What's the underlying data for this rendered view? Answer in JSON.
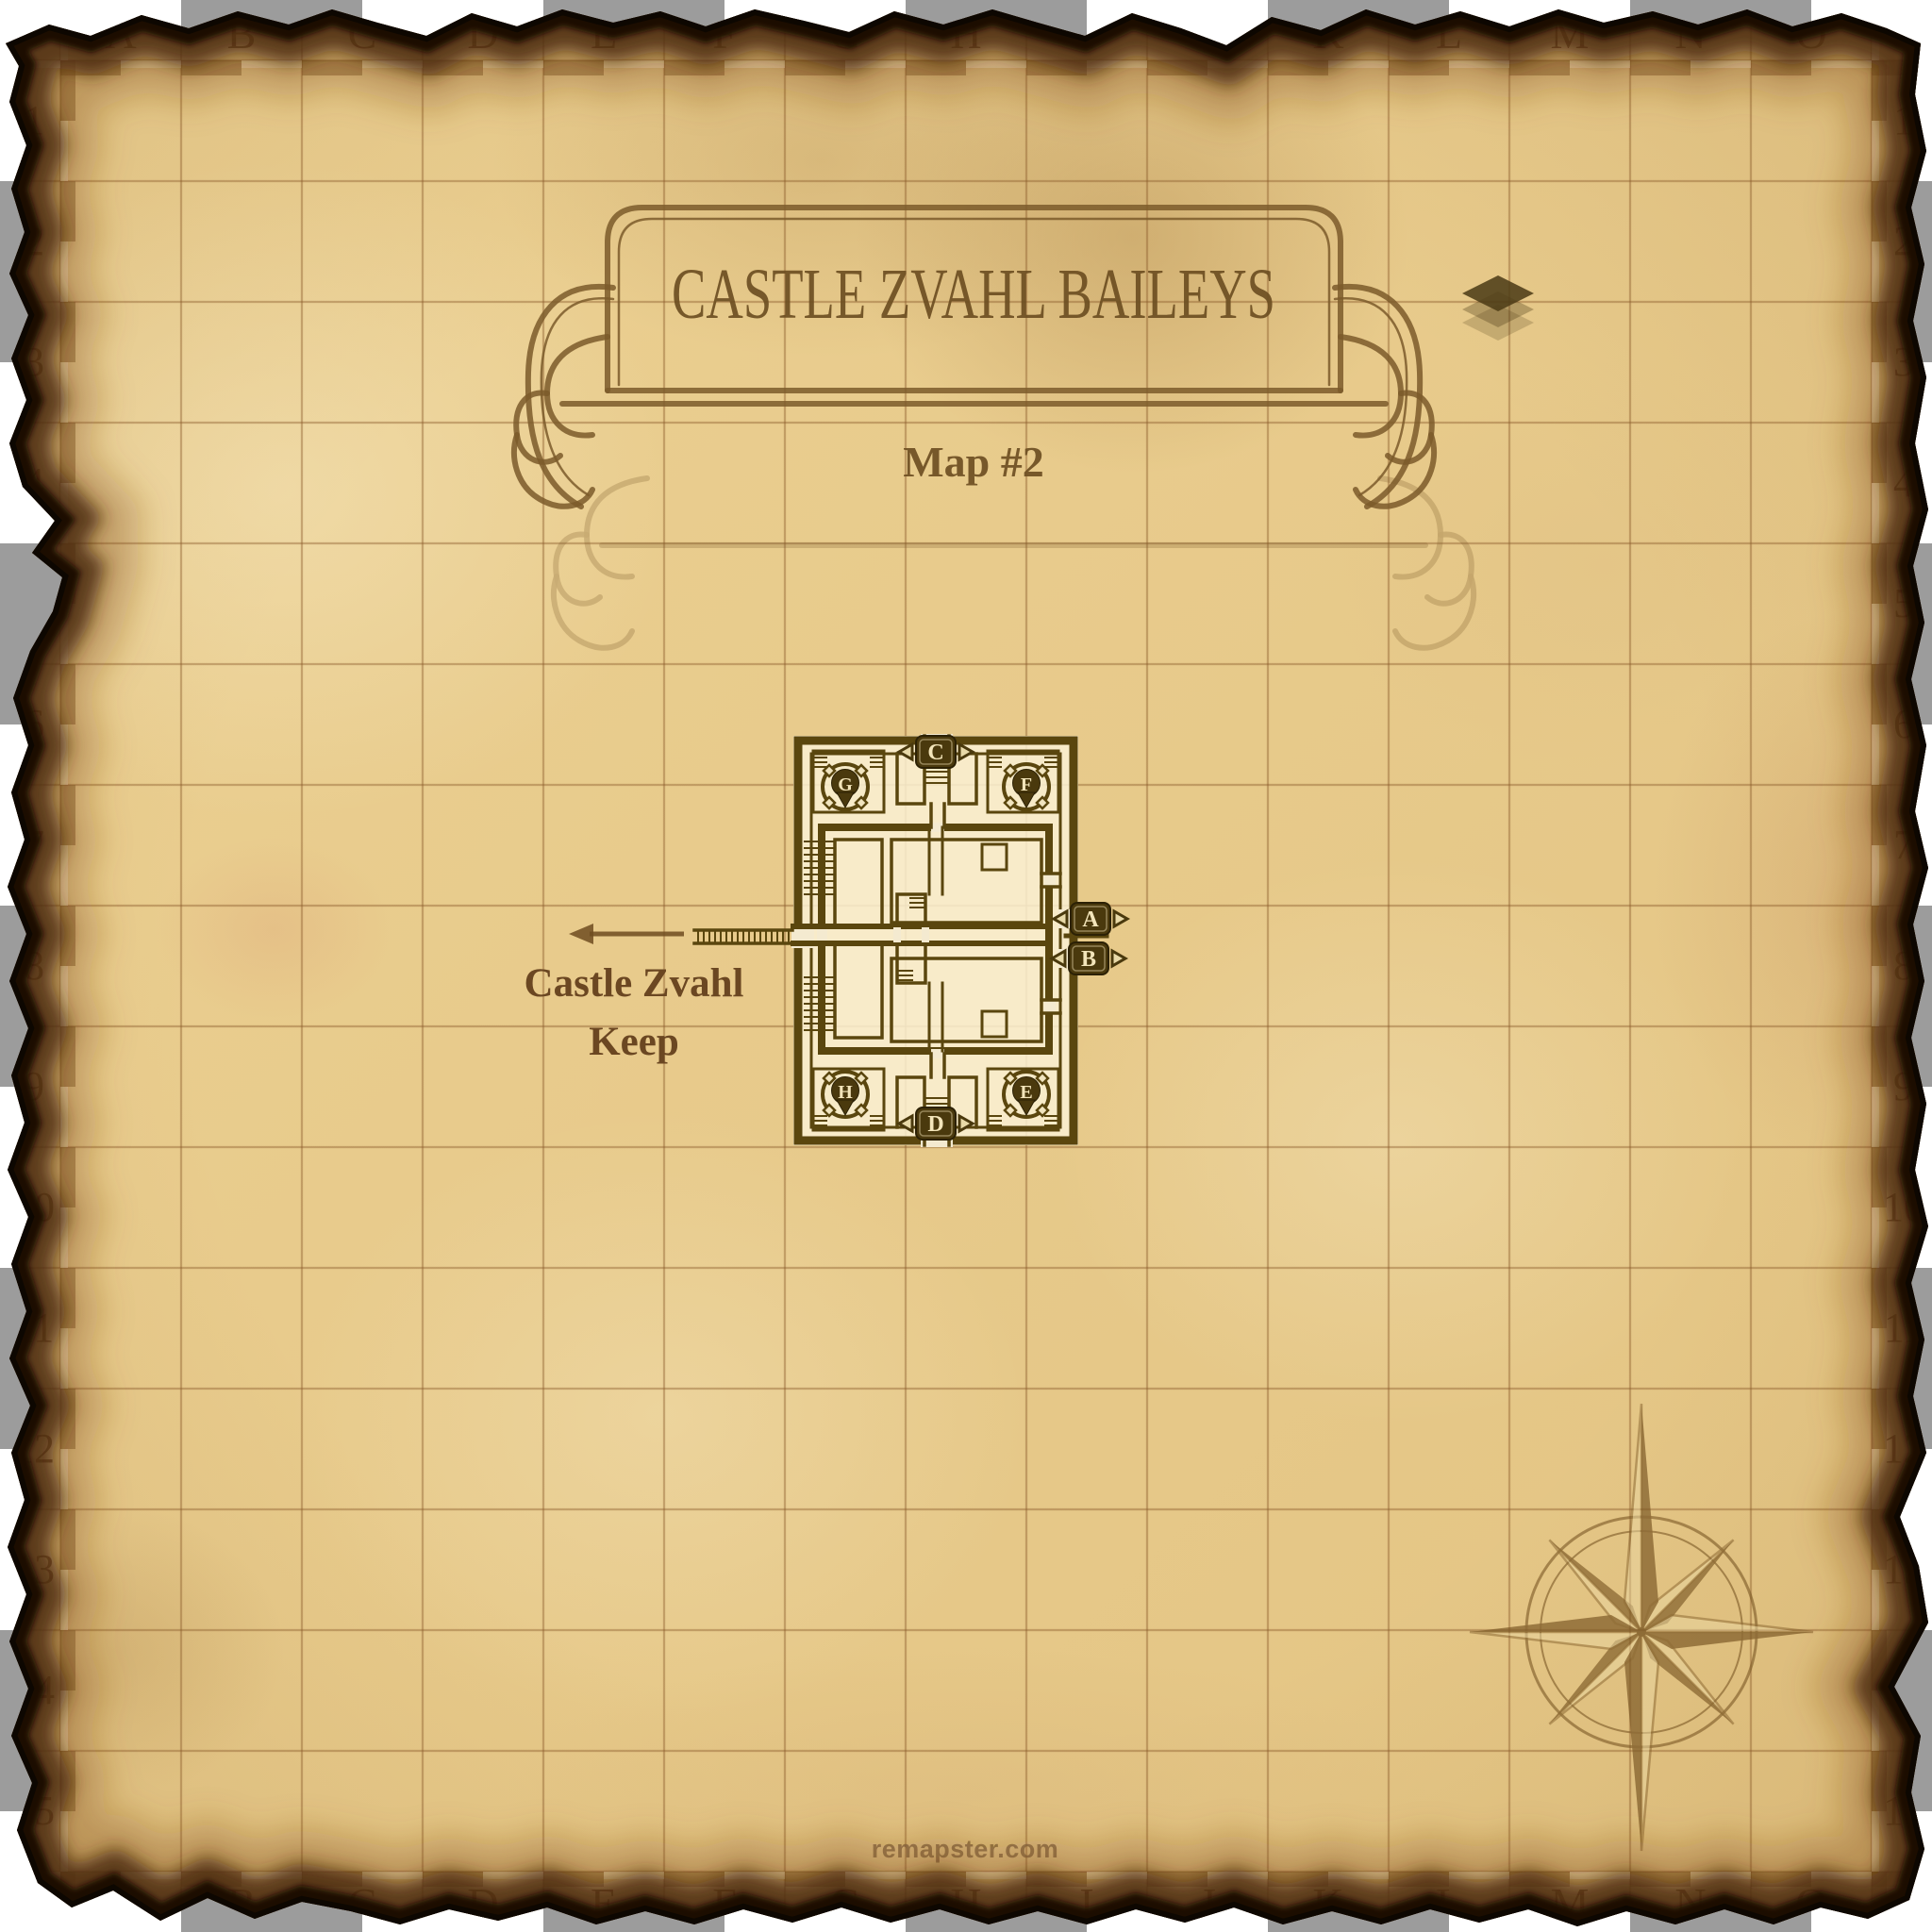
{
  "map": {
    "title": "CASTLE ZVAHL BAILEYS",
    "subtitle": "Map #2",
    "grid": {
      "columns": [
        "A",
        "B",
        "C",
        "D",
        "E",
        "F",
        "G",
        "H",
        "I",
        "J",
        "K",
        "L",
        "M",
        "N",
        "O"
      ],
      "rows": [
        "1",
        "2",
        "3",
        "4",
        "5",
        "6",
        "7",
        "8",
        "9",
        "10",
        "11",
        "12",
        "13",
        "14",
        "15"
      ]
    },
    "annotations": {
      "keep_line1": "Castle Zvahl",
      "keep_line2": "Keep"
    },
    "castle": {
      "exit_markers": [
        {
          "label": "A"
        },
        {
          "label": "B"
        },
        {
          "label": "C"
        },
        {
          "label": "D"
        }
      ],
      "pin_markers": [
        {
          "label": "E"
        },
        {
          "label": "F"
        },
        {
          "label": "G"
        },
        {
          "label": "H"
        }
      ]
    },
    "watermark": "remapster.com",
    "colors": {
      "parchment": "#e8cb8c",
      "ink": "#6e4a1c",
      "wall": "#5a460e",
      "badge_fill": "#4a390d",
      "badge_text": "#f3e5ba",
      "banner": "#7b5b2a",
      "burn": "#1a0d02"
    }
  }
}
